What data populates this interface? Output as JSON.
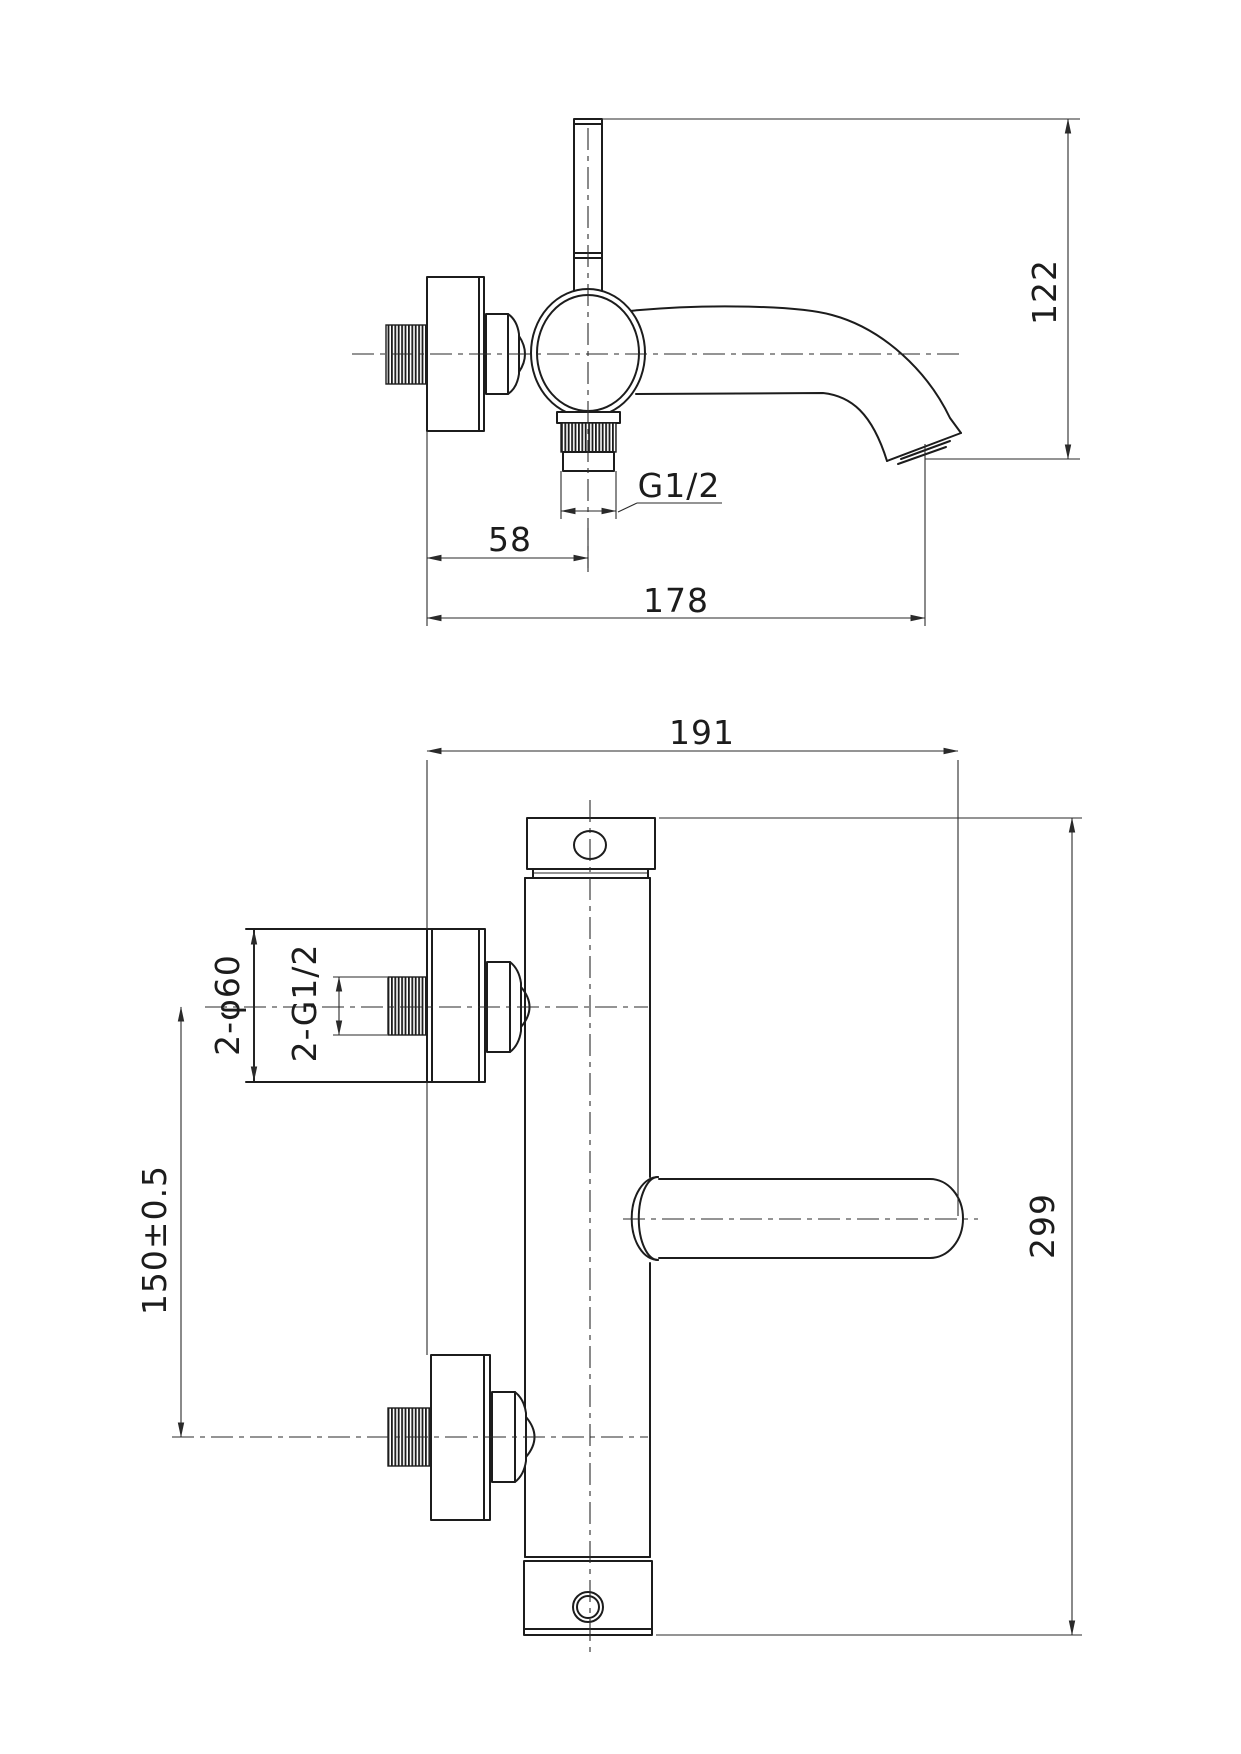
{
  "drawing": {
    "type": "technical-dimension-drawing",
    "subject": "wall-mounted bath mixer tap, two orthographic views",
    "background_color": "#ffffff",
    "line_color": "#1c1c1c"
  },
  "dimensions": {
    "side_view": {
      "overall_height": "122",
      "wall_to_outlet": "58",
      "spout_reach": "178",
      "outlet_thread": "G1/2"
    },
    "front_view": {
      "overall_width": "191",
      "overall_height": "299",
      "inlet_spacing": "150±0.5",
      "escutcheon_diameter": "2-φ60",
      "inlet_thread": "2-G1/2"
    }
  }
}
